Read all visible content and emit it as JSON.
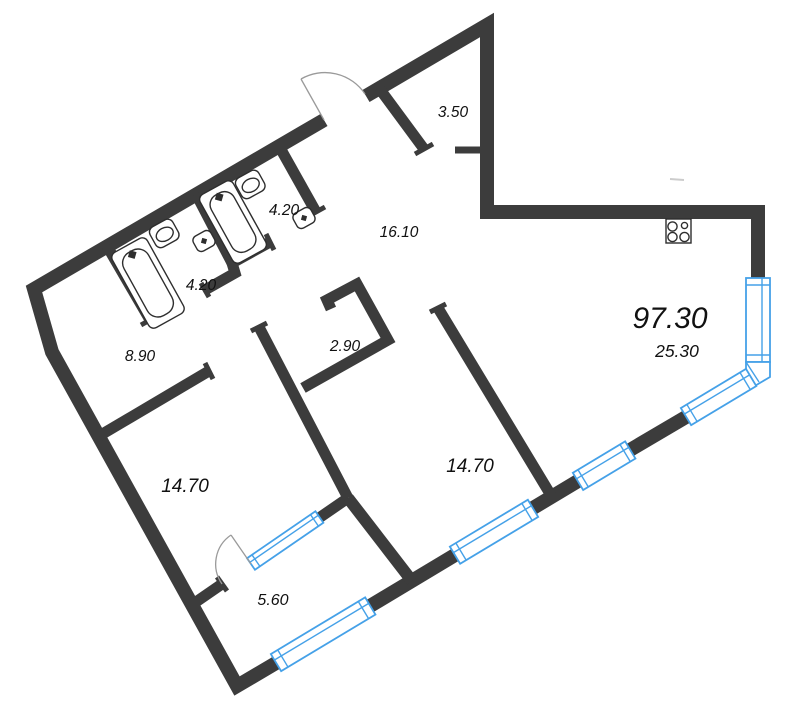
{
  "floorplan": {
    "total_area": "97.30",
    "living_room_area": "25.30",
    "rooms": [
      {
        "id": "entry-hall",
        "area": "3.50"
      },
      {
        "id": "bathroom-right",
        "area": "4.20"
      },
      {
        "id": "bathroom-left",
        "area": "4.20"
      },
      {
        "id": "corridor",
        "area": "16.10"
      },
      {
        "id": "inner-hallway",
        "area": "8.90"
      },
      {
        "id": "closet",
        "area": "2.90"
      },
      {
        "id": "bedroom-left",
        "area": "14.70"
      },
      {
        "id": "bedroom-center",
        "area": "14.70"
      },
      {
        "id": "balcony",
        "area": "5.60"
      }
    ],
    "colors": {
      "wall": "#3c3c3c",
      "window": "#45a1e8",
      "door_arc": "#9a9a9a",
      "fixture": "#2e2e2e",
      "label": "#111111",
      "background": "#ffffff"
    },
    "fixtures": [
      {
        "name": "bathtub-icon",
        "count": 2
      },
      {
        "name": "sink-icon",
        "count": 2
      },
      {
        "name": "toilet-icon",
        "count": 2
      },
      {
        "name": "stove-icon",
        "count": 1
      }
    ]
  }
}
